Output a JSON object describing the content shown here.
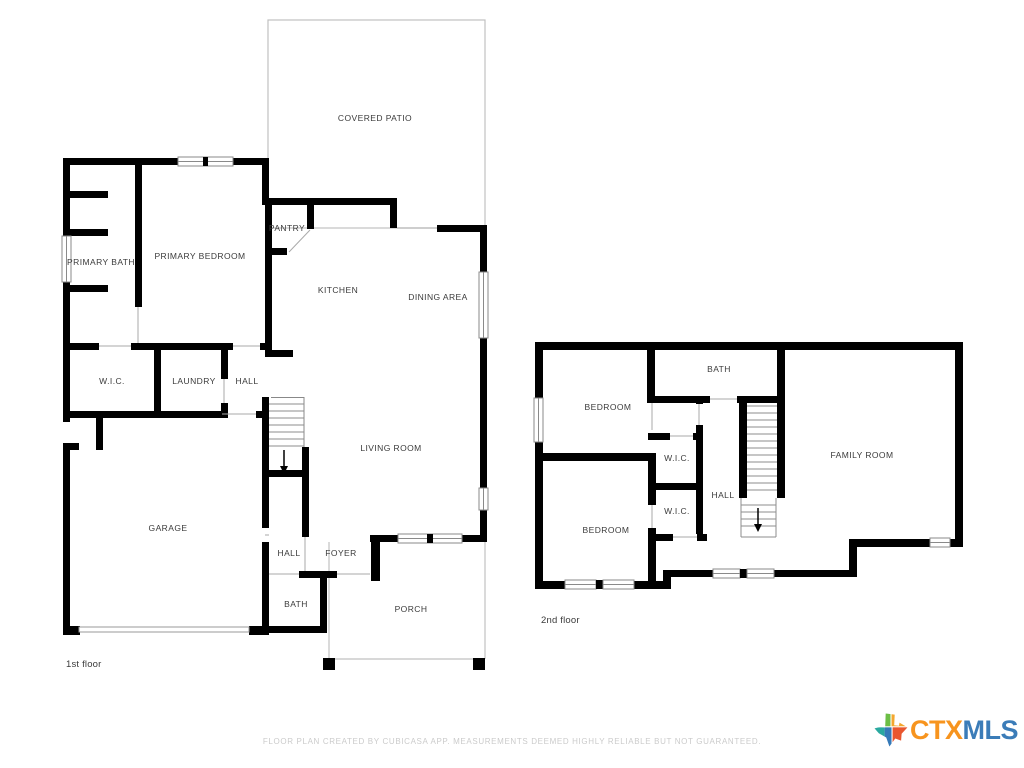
{
  "floor1": {
    "caption": "1st floor",
    "rooms": {
      "covered_patio": "COVERED PATIO",
      "pantry": "PANTRY",
      "primary_bath": "PRIMARY BATH",
      "primary_bedroom": "PRIMARY BEDROOM",
      "kitchen": "KITCHEN",
      "dining_area": "DINING AREA",
      "wic": "W.I.C.",
      "laundry": "LAUNDRY",
      "hall_upper": "HALL",
      "living_room": "LIVING ROOM",
      "garage": "GARAGE",
      "hall_lower": "HALL",
      "foyer": "FOYER",
      "bath": "BATH",
      "porch": "PORCH"
    }
  },
  "floor2": {
    "caption": "2nd floor",
    "rooms": {
      "bedroom_top": "BEDROOM",
      "bath": "BATH",
      "wic_top": "W.I.C.",
      "wic_bottom": "W.I.C.",
      "hall": "HALL",
      "family_room": "FAMILY ROOM",
      "bedroom_bottom": "BEDROOM"
    }
  },
  "footer": {
    "disclaimer": "FLOOR PLAN CREATED BY CUBICASA APP. MEASUREMENTS DEEMED HIGHLY RELIABLE BUT NOT GUARANTEED."
  },
  "logo": {
    "ctx": "CTX",
    "mls": "MLS",
    "icon": "texas-state-icon"
  },
  "colors": {
    "wall": "#000000",
    "label_text": "#3b3b3b",
    "thin_line": "#9a9a9a",
    "patio_outline": "#c0c0c0",
    "disclaimer_text": "#cbcbcb",
    "logo_orange": "#F7941E",
    "logo_blue": "#3B7CB8",
    "texas_green": "#6CBE45",
    "texas_amber": "#F3A72E",
    "texas_teal": "#2AA9A0",
    "texas_blue": "#3579B8",
    "texas_orange": "#E9562F"
  }
}
